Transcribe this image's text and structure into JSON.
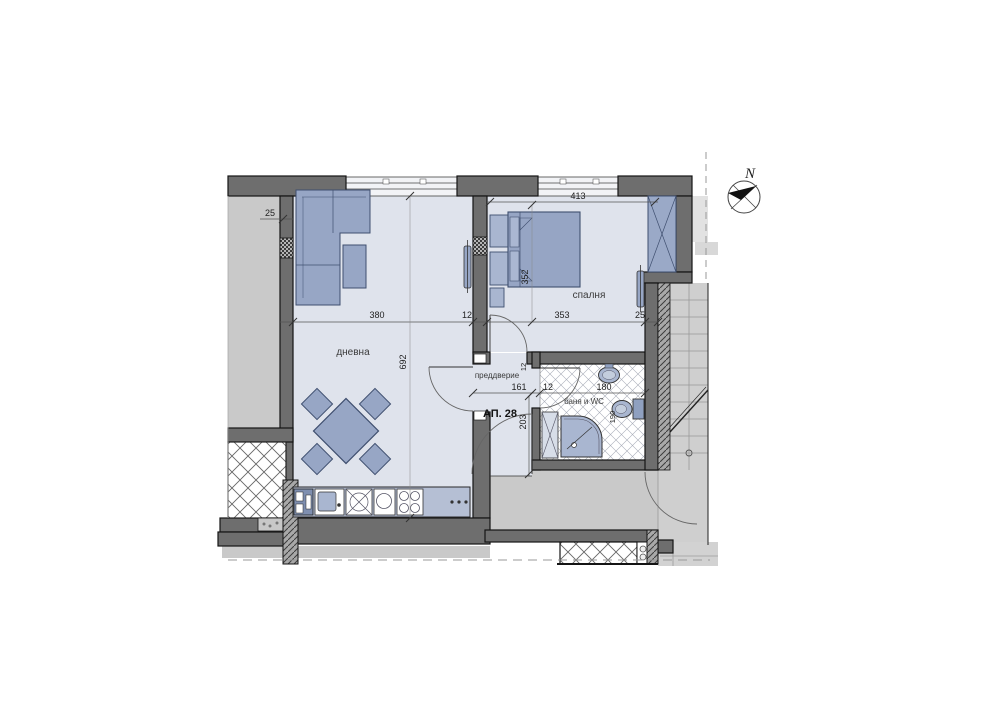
{
  "plan": {
    "apartment_label": "АП. 28",
    "compass": {
      "label": "N"
    },
    "rooms": {
      "living": "дневна",
      "bedroom": "спалня",
      "hall": "преддверие",
      "bath": "баня и WC"
    },
    "dimensions": {
      "left_wall_offset": "25",
      "living_width": "380",
      "partition_thickness": "12",
      "bedroom_width": "353",
      "bedroom_edge": "25",
      "bedroom_top_width": "413",
      "bedroom_depth": "352",
      "living_depth": "692",
      "hall_width": "161",
      "hall_wall_thickness": "12",
      "bath_width": "180",
      "hall_depth": "203",
      "wc_width": "190",
      "bath_wall_thickness": "12"
    },
    "colors": {
      "floor": "#dfe3ec",
      "wall": "#6e6e6e",
      "furniture": "#97a6c5",
      "furniture_light": "#a9b6d0",
      "counter": "#b5bfd4",
      "neighbor_area": "#c9c9c9",
      "stairs": "#cfcfcf",
      "outline": "#141414"
    }
  }
}
